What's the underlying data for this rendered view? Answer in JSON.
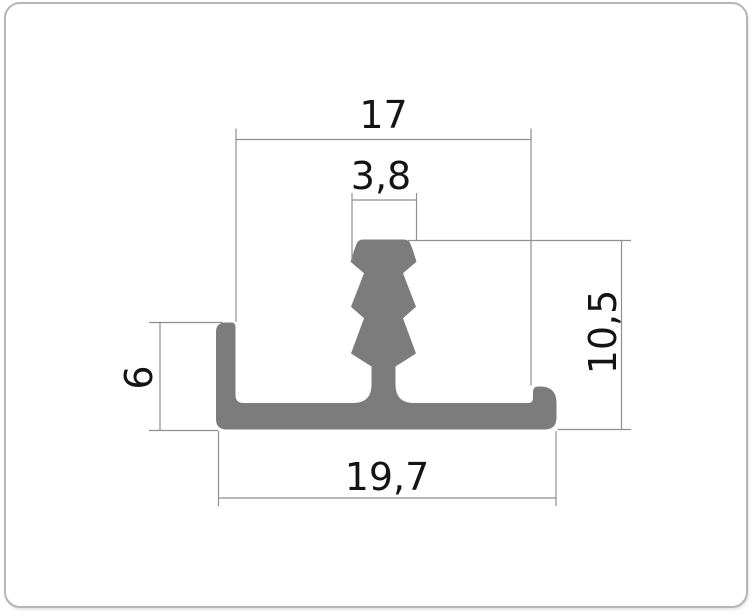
{
  "card": {
    "background": "#ffffff",
    "border_color": "#b4b6b8"
  },
  "diagram": {
    "profile_color": "#7c7c7c",
    "line_color": "#8f8f8f",
    "text_color": "#141414",
    "dimensions": {
      "top_width": "17",
      "barb_width": "3,8",
      "right_height": "10,5",
      "left_height": "6",
      "bottom_width": "19,7"
    }
  }
}
